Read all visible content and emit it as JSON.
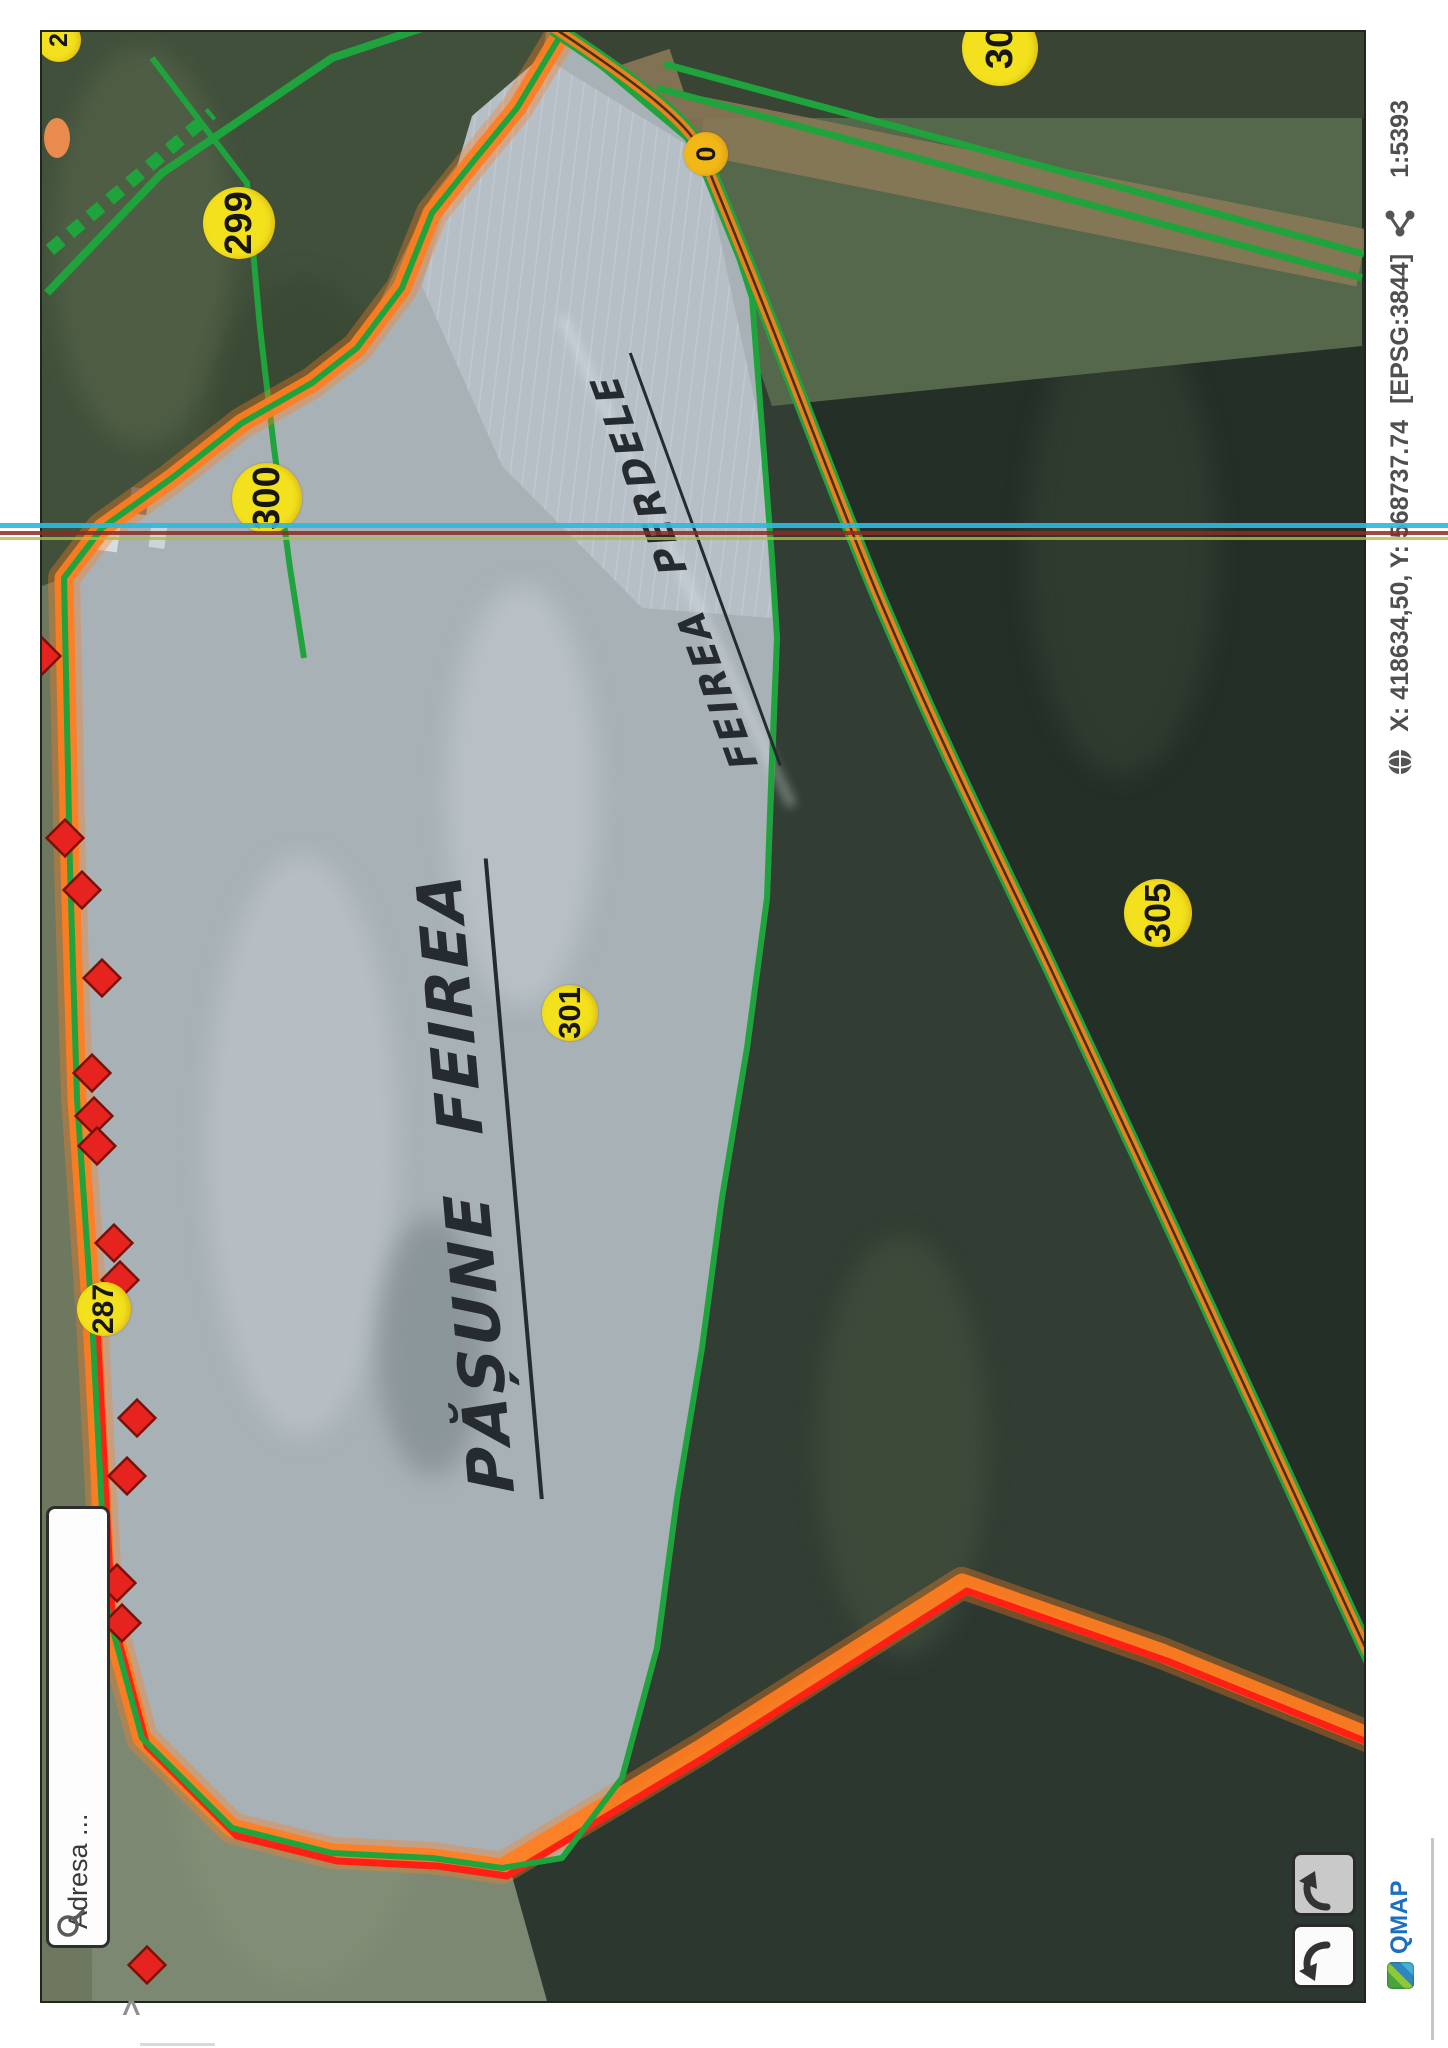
{
  "map": {
    "labels": [
      {
        "text": "299"
      },
      {
        "text": "300"
      },
      {
        "text": "0"
      },
      {
        "text": "30"
      },
      {
        "text": "2"
      },
      {
        "text": "287"
      },
      {
        "text": "301"
      },
      {
        "text": "305"
      }
    ],
    "annotations": [
      {
        "text": "PĂȘUNE FEIREA"
      },
      {
        "text": "FEIREA PERDELE"
      }
    ],
    "colors": {
      "boundary_green": "#1fa33c",
      "highlight_orange": "#ff7d1f",
      "highlight_red": "#ff2015",
      "label_yellow": "#f2e11c",
      "marker_red": "#e6231e"
    }
  },
  "search": {
    "placeholder": "Adresa ...",
    "icon": "magnifier-icon"
  },
  "nav": {
    "previous_icon": "curved-arrow-left",
    "next_icon": "curved-arrow-right"
  },
  "statusbar": {
    "logo_text": "QMAP",
    "coordinates": "X: 418634,50, Y: 568737.74",
    "crs": "[EPSG:3844]",
    "scale": "1:5393",
    "globe_icon": "globe-icon",
    "share_icon": "share-icon"
  },
  "artifacts": {
    "chevron": "^"
  }
}
